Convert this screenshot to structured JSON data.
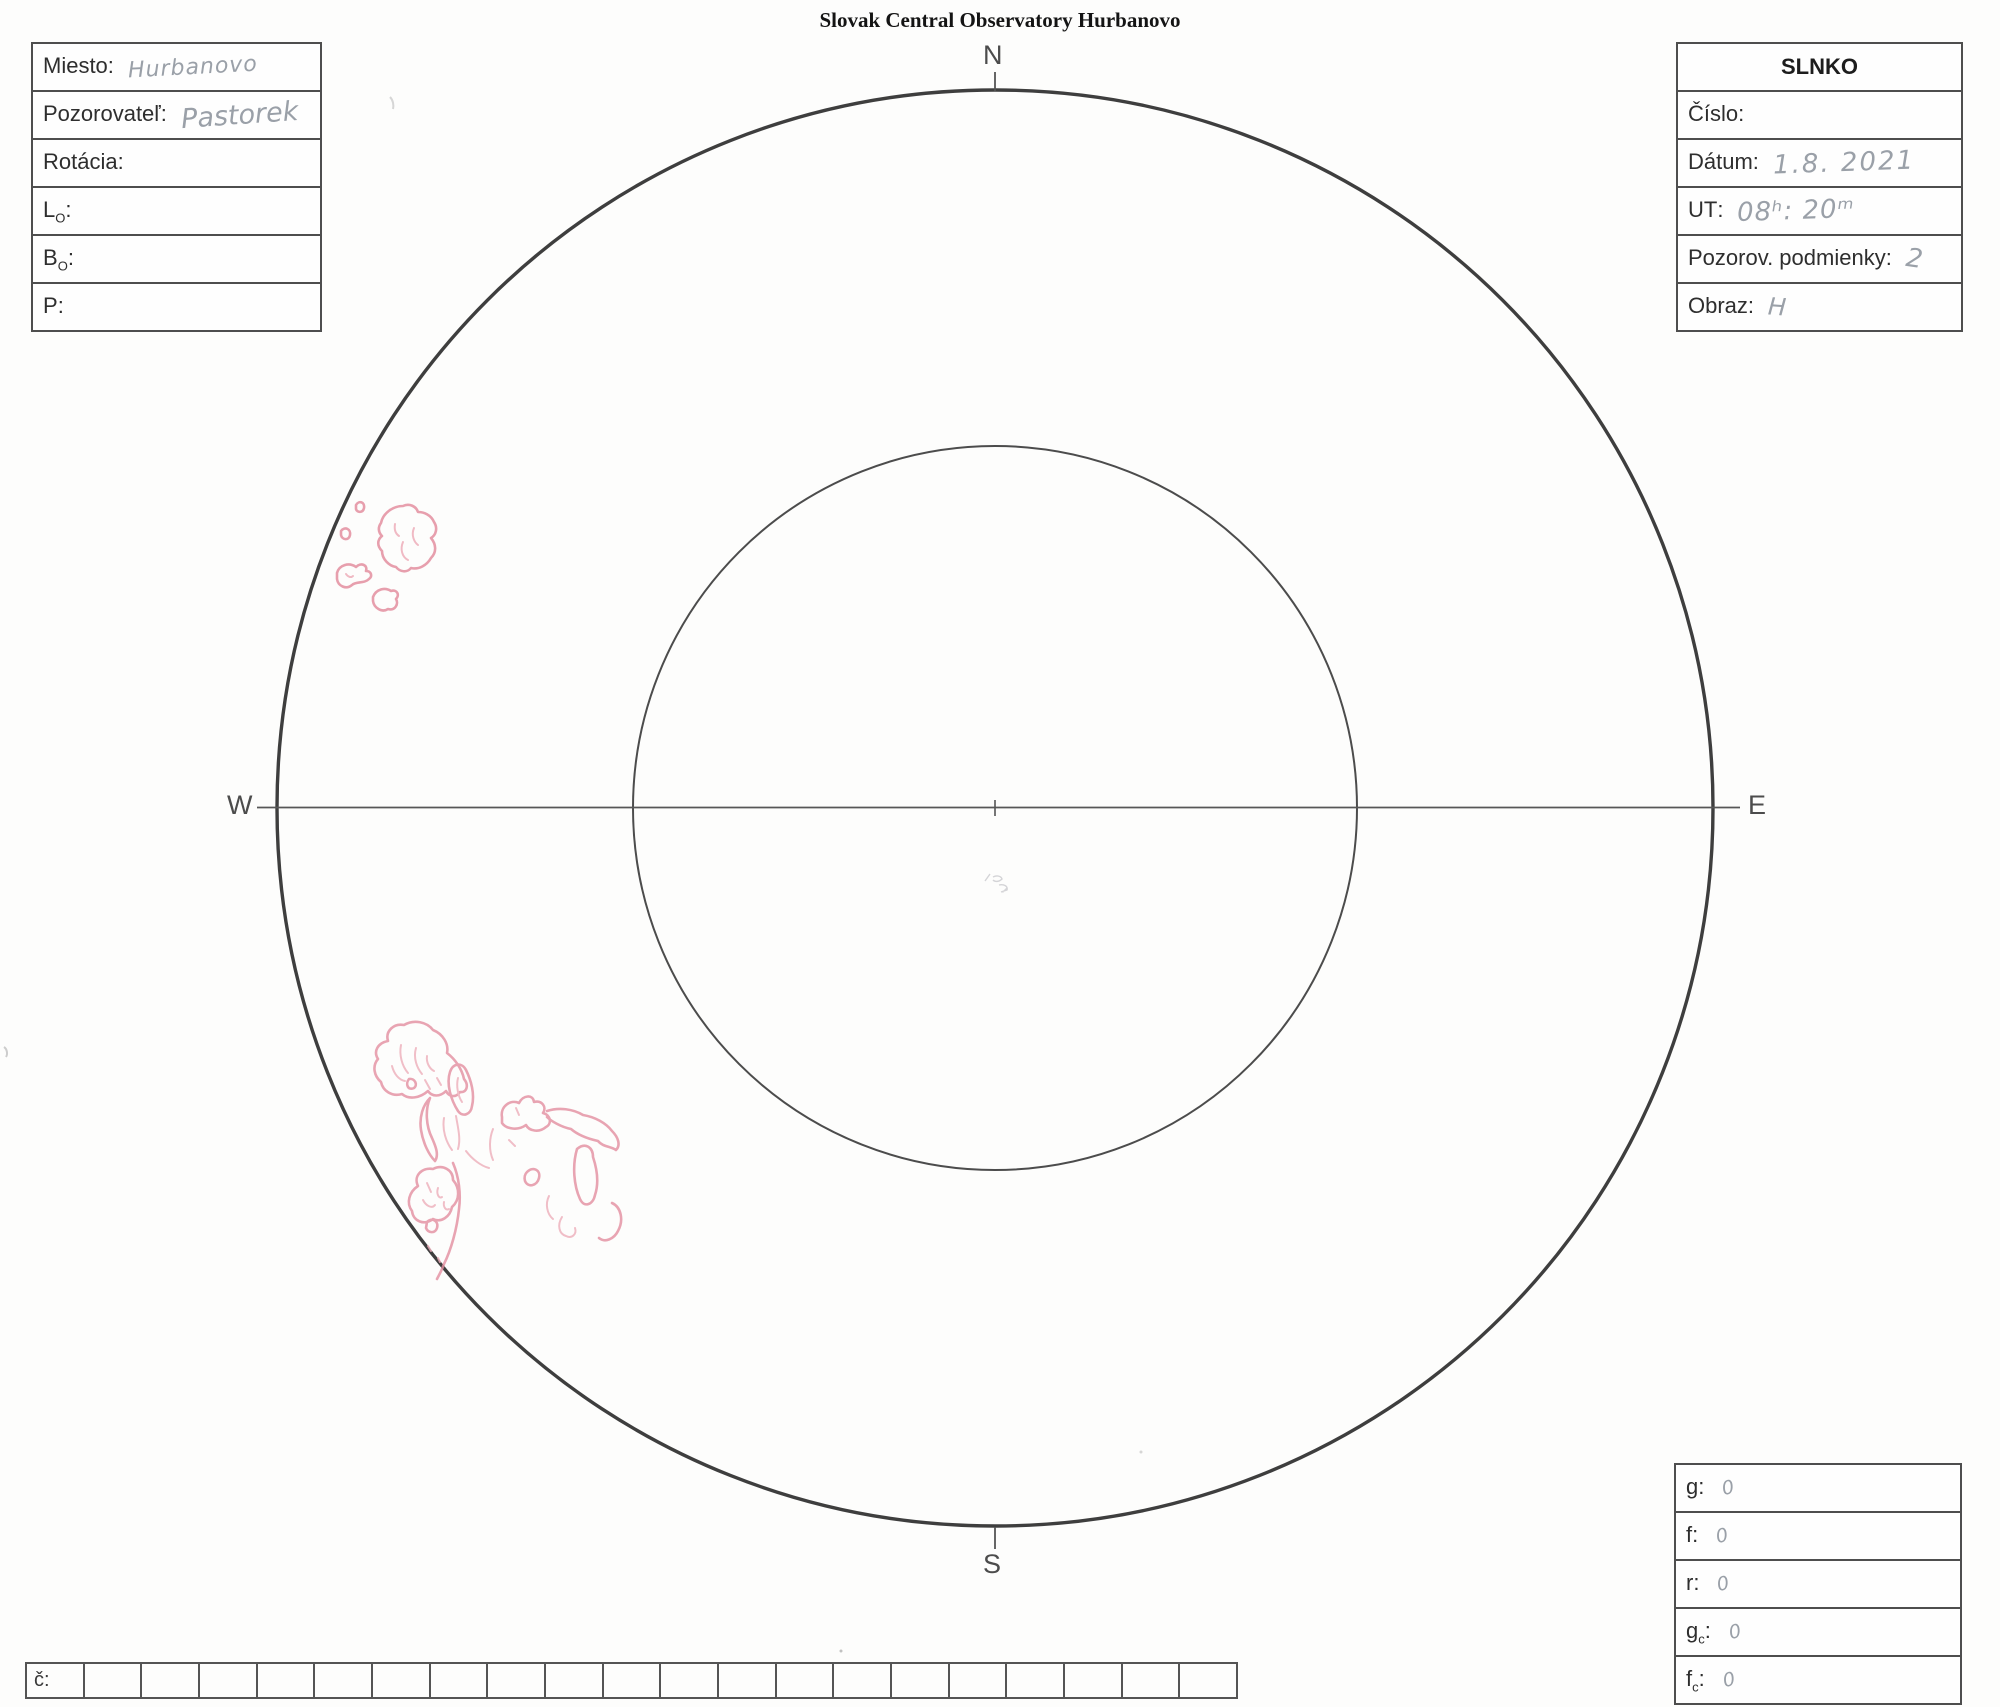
{
  "title": "Slovak Central Observatory Hurbanovo",
  "compass": {
    "north": "N",
    "south": "S",
    "west": "W",
    "east": "E"
  },
  "left_panel": {
    "fields": [
      {
        "base": "Miesto",
        "sub": "",
        "colon": ":",
        "value": "Hurbanovo"
      },
      {
        "base": "Pozorovateľ",
        "sub": "",
        "colon": ":",
        "value": "Pastorek"
      },
      {
        "base": "Rotácia",
        "sub": "",
        "colon": ":",
        "value": ""
      },
      {
        "base": "L",
        "sub": "O",
        "colon": ":",
        "value": ""
      },
      {
        "base": "B",
        "sub": "O",
        "colon": ":",
        "value": ""
      },
      {
        "base": "P",
        "sub": "",
        "colon": ":",
        "value": ""
      }
    ]
  },
  "right_panel": {
    "header": "SLNKO",
    "fields": [
      {
        "base": "Číslo",
        "sub": "",
        "colon": ":",
        "value": ""
      },
      {
        "base": "Dátum",
        "sub": "",
        "colon": ":",
        "value": "1.8. 2021"
      },
      {
        "base": "UT",
        "sub": "",
        "colon": ":",
        "value": "08ʰ: 20ᵐ"
      },
      {
        "base": "Pozorov. podmienky",
        "sub": "",
        "colon": ":",
        "value": "2"
      },
      {
        "base": "Obraz",
        "sub": "",
        "colon": ":",
        "value": "H"
      }
    ]
  },
  "counts_panel": {
    "fields": [
      {
        "base": "g",
        "sub": "",
        "colon": ":",
        "value": "0"
      },
      {
        "base": "f",
        "sub": "",
        "colon": ":",
        "value": "0"
      },
      {
        "base": "r",
        "sub": "",
        "colon": ":",
        "value": "0"
      },
      {
        "base": "g",
        "sub": "c",
        "colon": ":",
        "value": "0"
      },
      {
        "base": "f",
        "sub": "c",
        "colon": ":",
        "value": "0"
      }
    ]
  },
  "bottom_row": {
    "label": "č:"
  },
  "sunspots": {
    "stroke_color": "#e48fa0",
    "groups": [
      "northwest-limb-group",
      "southwest-group"
    ]
  }
}
